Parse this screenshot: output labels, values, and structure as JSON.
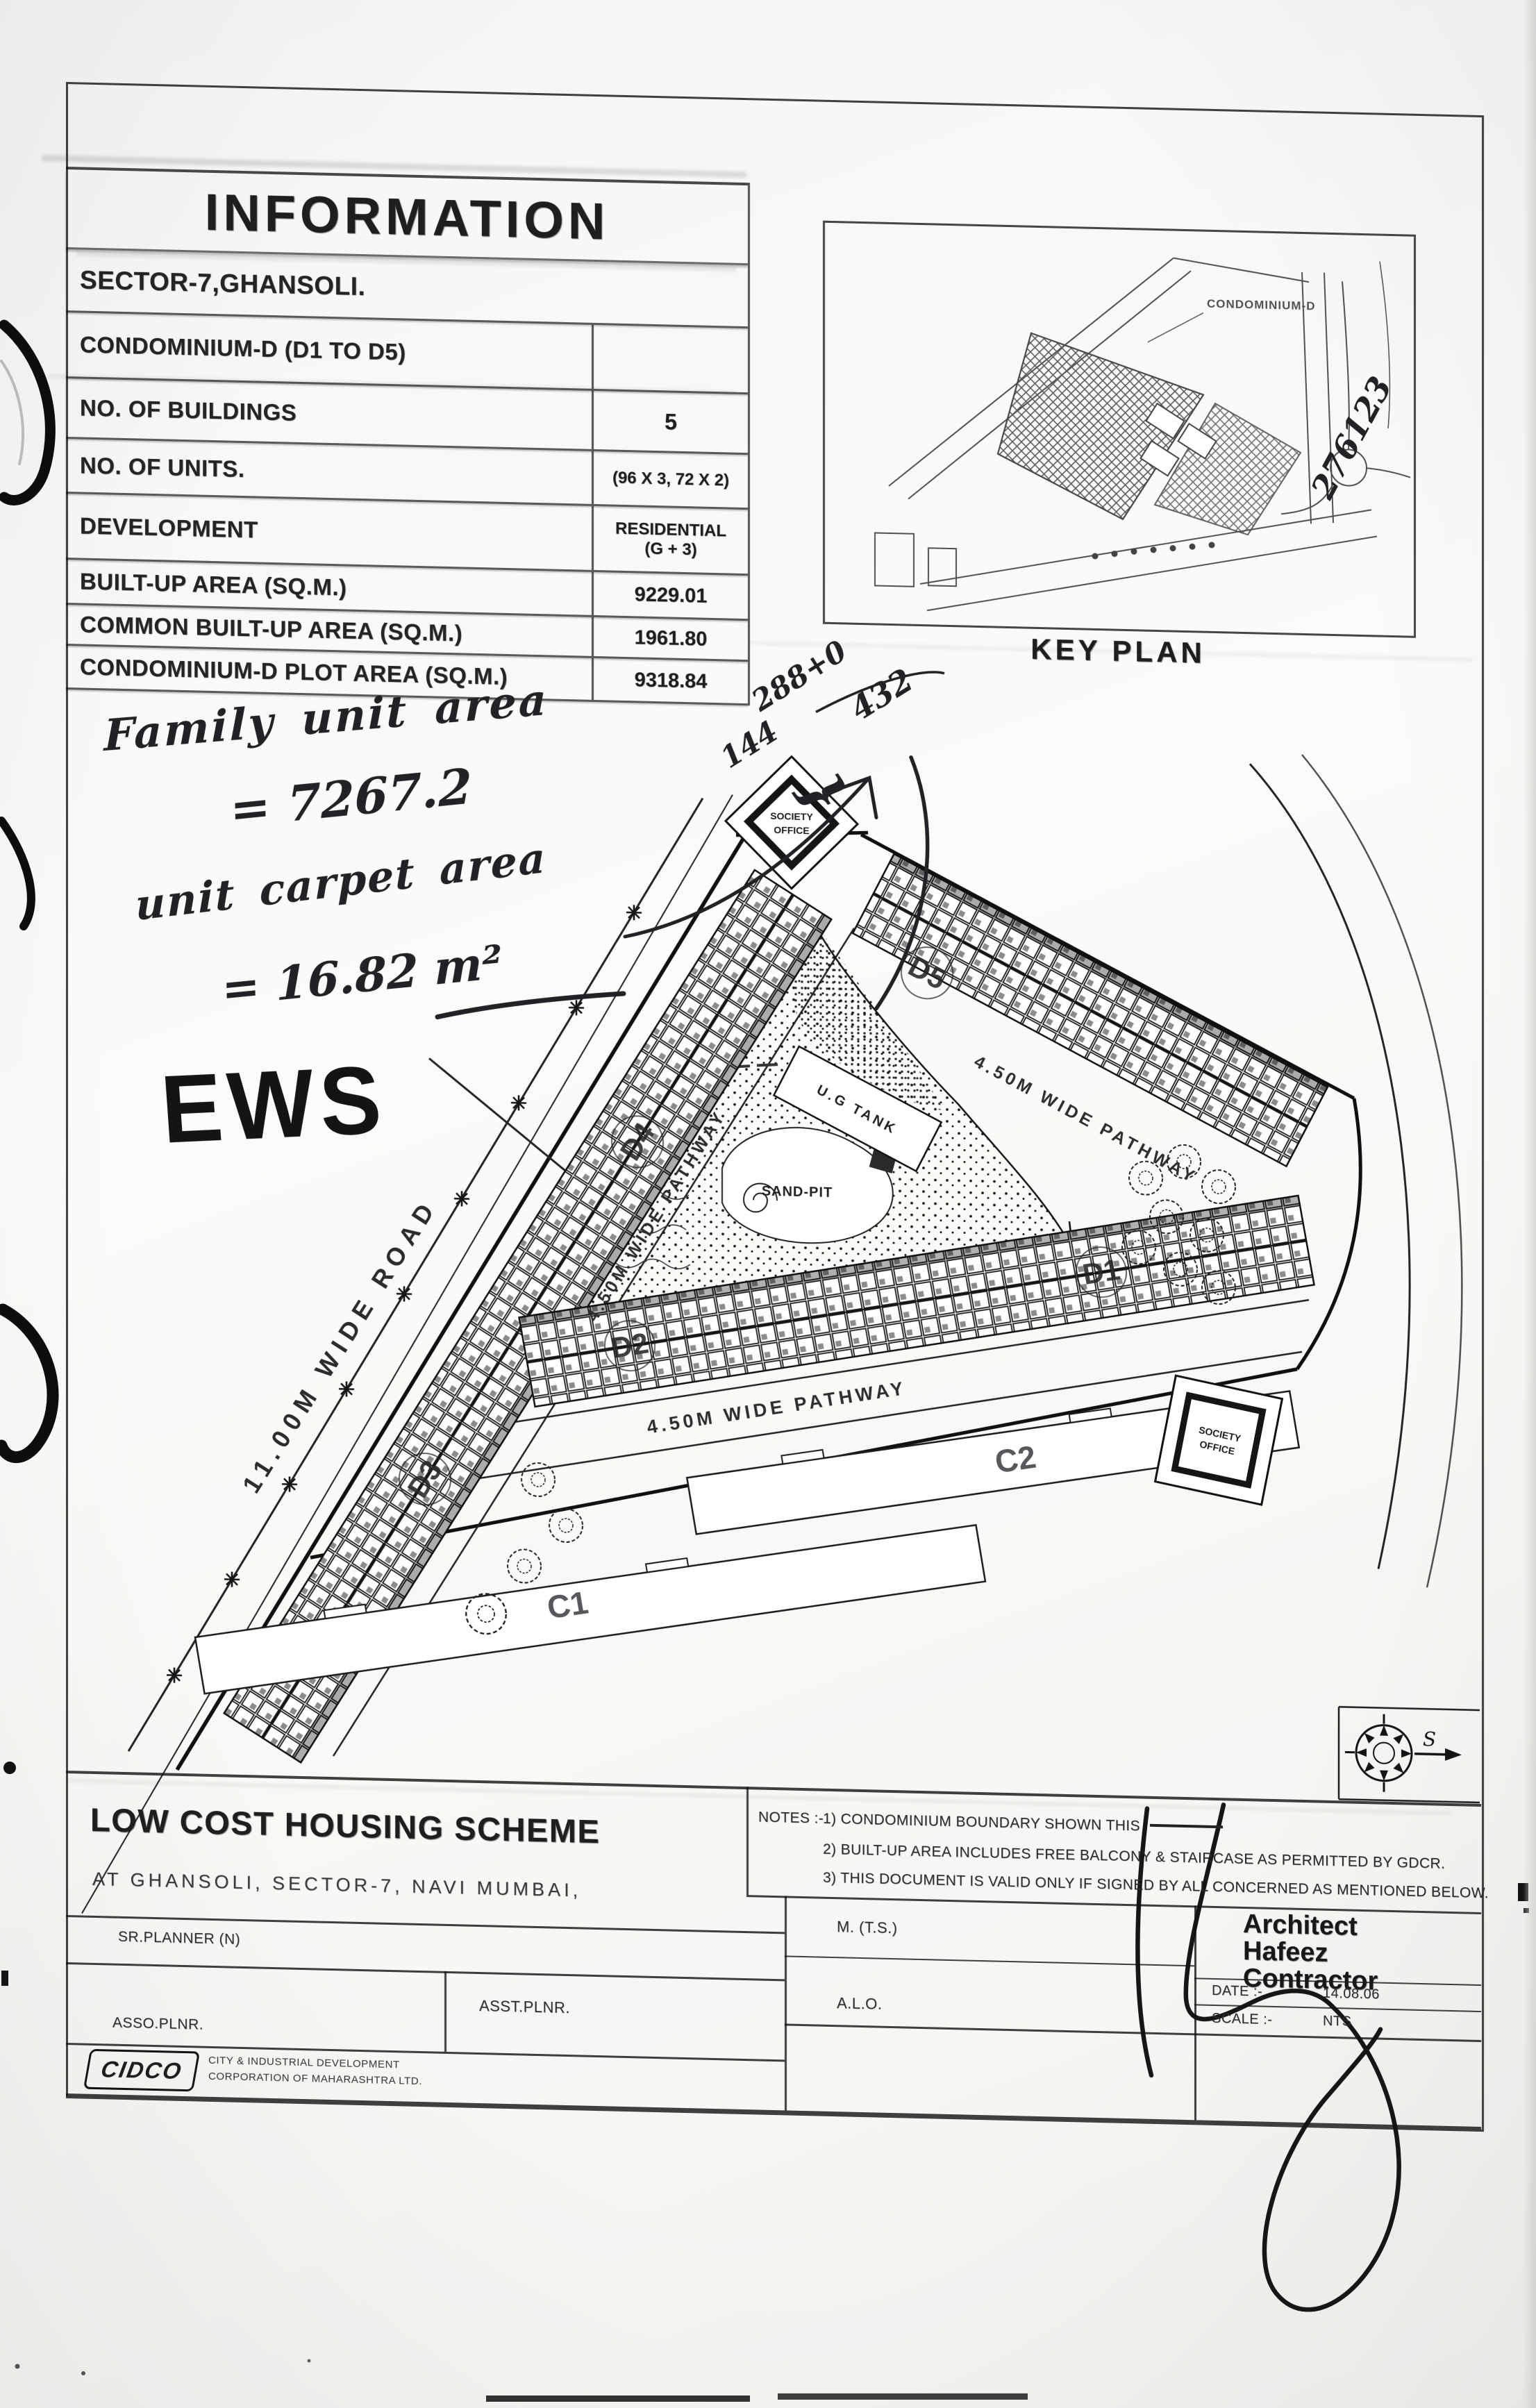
{
  "info": {
    "title": "INFORMATION",
    "rows": [
      {
        "label": "SECTOR-7,GHANSOLI.",
        "value": ""
      },
      {
        "label": "CONDOMINIUM-D (D1 TO D5)",
        "value": ""
      },
      {
        "label": "NO. OF BUILDINGS",
        "value": "5"
      },
      {
        "label": "NO. OF UNITS.",
        "value": "(96 X 3, 72 X 2)"
      },
      {
        "label": "DEVELOPMENT",
        "value": "RESIDENTIAL",
        "value2": "(G + 3)"
      },
      {
        "label": "BUILT-UP AREA (SQ.M.)",
        "value": "9229.01"
      },
      {
        "label": "COMMON BUILT-UP AREA (SQ.M.)",
        "value": "1961.80"
      },
      {
        "label": "CONDOMINIUM-D PLOT AREA (SQ.M.)",
        "value": "9318.84"
      }
    ]
  },
  "key_plan": {
    "caption": "KEY PLAN",
    "area_label": "CONDOMINIUM-D"
  },
  "handwriting": {
    "corner_ref": "276123",
    "family_area_label": "Family unit area",
    "family_area_value": "= 7267.2",
    "carpet_area_label": "unit carpet area",
    "carpet_area_value": "= 16.82 m²",
    "ews": "EWS",
    "calc_numerator": "288+0",
    "calc_denominator": "144",
    "calc_brace": "}",
    "calc_result": "432"
  },
  "plan": {
    "road_label": "11.00M WIDE ROAD",
    "pathway_label": "4.50M WIDE PATHWAY",
    "ug_tank_label": "U.G TANK",
    "sand_pit_label": "SAND-PIT",
    "society_line1": "SOCIETY",
    "society_line2": "OFFICE",
    "buildings": [
      "D1",
      "D2",
      "D3",
      "D4",
      "D5",
      "C1",
      "C2"
    ]
  },
  "title_block": {
    "project_title": "LOW COST HOUSING SCHEME",
    "project_location": "AT GHANSOLI, SECTOR-7, NAVI MUMBAI,",
    "notes_heading": "NOTES :-",
    "note1": "1) CONDOMINIUM BOUNDARY SHOWN THIS",
    "note2": "2) BUILT-UP AREA INCLUDES FREE BALCONY & STAIRCASE AS PERMITTED BY GDCR.",
    "note3": "3) THIS DOCUMENT IS VALID ONLY IF SIGNED BY ALL CONCERNED AS MENTIONED BELOW.",
    "sr_planner": "SR.PLANNER (N)",
    "asso_plnr": "ASSO.PLNR.",
    "asst_plnr": "ASST.PLNR.",
    "m_ts": "M. (T.S.)",
    "alo": "A.L.O.",
    "architect_name": "Architect\nHafeez\nContractor",
    "date_label": "DATE :-",
    "date_value": "14.08.06",
    "scale_label": "SCALE :-",
    "scale_value": "NTS",
    "logo_text": "CIDCO",
    "corp_line1": "CITY & INDUSTRIAL DEVELOPMENT",
    "corp_line2": "CORPORATION OF MAHARASHTRA LTD."
  },
  "compass": {
    "south_label": "S"
  }
}
